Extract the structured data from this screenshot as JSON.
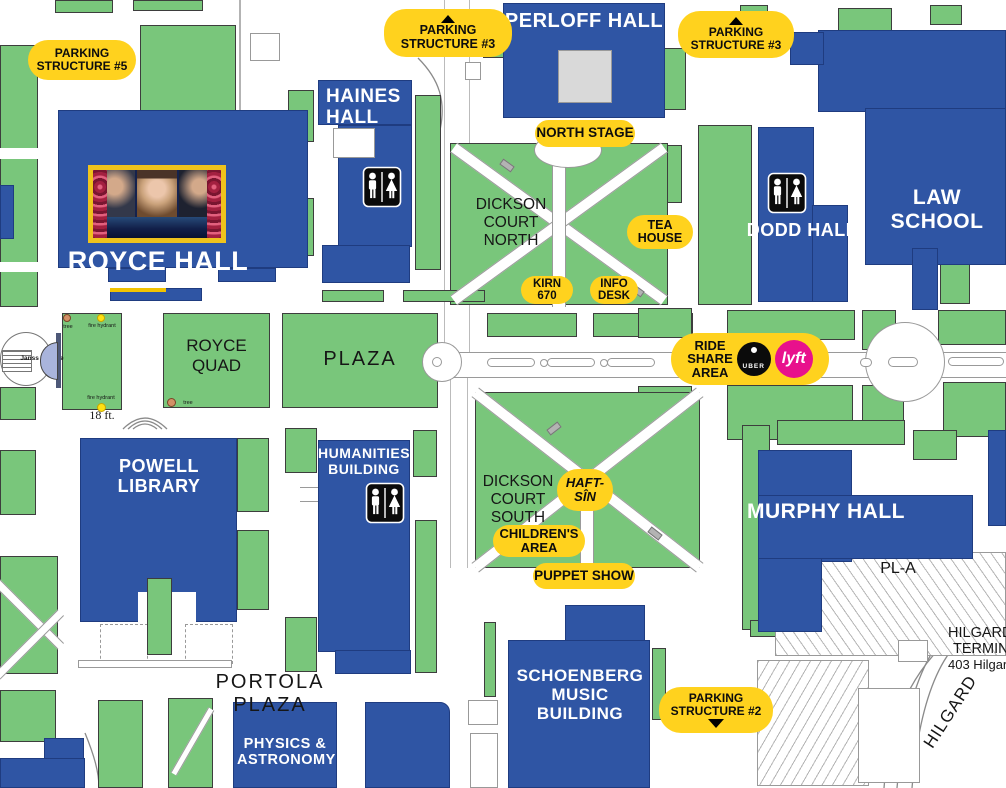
{
  "colors": {
    "building_blue": "#2F55A4",
    "area_green": "#79C67B",
    "pill_yellow": "#FFD21E",
    "lyft_pink": "#E8118C",
    "uber_black": "#0B0B0B",
    "fountain_lavender": "#A9B4DC",
    "photo_frame_yellow": "#EFC31C"
  },
  "buildings": {
    "royce": {
      "label": "ROYCE HALL"
    },
    "haines": {
      "l1": "HAINES",
      "l2": "HALL"
    },
    "perloff": {
      "label": "PERLOFF HALL"
    },
    "law": {
      "label": "LAW SCHOOL"
    },
    "dodd": {
      "l1": "DODD",
      "l2": "HALL"
    },
    "powell": {
      "label": "POWELL LIBRARY"
    },
    "humanities": {
      "l1": "HUMANITIES",
      "l2": "BUILDING"
    },
    "murphy": {
      "l1": "MURPHY",
      "l2": "HALL"
    },
    "schoenberg": {
      "l1": "SCHOENBERG",
      "l2": "MUSIC BUILDING"
    },
    "physics": {
      "l1": "PHYSICS &",
      "l2": "ASTRONOMY"
    }
  },
  "areas": {
    "dickson_north": {
      "l1": "DICKSON",
      "l2": "COURT",
      "l3": "NORTH"
    },
    "dickson_south": {
      "l1": "DICKSON",
      "l2": "COURT",
      "l3": "SOUTH"
    },
    "royce_quad": {
      "l1": "ROYCE",
      "l2": "QUAD"
    },
    "plaza": {
      "label": "PLAZA"
    },
    "portola": {
      "label": "PORTOLA PLAZA"
    }
  },
  "pills": {
    "parking5": {
      "l1": "PARKING",
      "l2": "STRUCTURE #5"
    },
    "parking3": {
      "l1": "PARKING",
      "l2": "STRUCTURE #3"
    },
    "parking2": {
      "l1": "PARKING",
      "l2": "STRUCTURE #2"
    },
    "north_stage": {
      "label": "NORTH STAGE"
    },
    "tea_house": {
      "l1": "TEA",
      "l2": "HOUSE"
    },
    "kirn": {
      "l1": "KIRN",
      "l2": "670"
    },
    "info_desk": {
      "l1": "INFO",
      "l2": "DESK"
    },
    "ride_share": {
      "l1": "RIDE",
      "l2": "SHARE",
      "l3": "AREA"
    },
    "haft_sin": {
      "l1": "HAFT-",
      "l2": "SÎN"
    },
    "childrens_area": {
      "l1": "CHILDREN'S",
      "l2": "AREA"
    },
    "puppet_show": {
      "label": "PUPPET SHOW"
    }
  },
  "logos": {
    "uber": "UBER",
    "lyft": "lyft"
  },
  "street_labels": {
    "hilgard": "HILGARD",
    "pl_a": "PL-A",
    "terminal": {
      "l1": "HILGARD",
      "l2": "TERMINAL",
      "l3": "403 Hilgard"
    }
  },
  "small_labels": {
    "janss": "Janss Terrace",
    "tree": "tree",
    "fire_hydrant": "fire hydrant",
    "scale": "18 ft."
  }
}
